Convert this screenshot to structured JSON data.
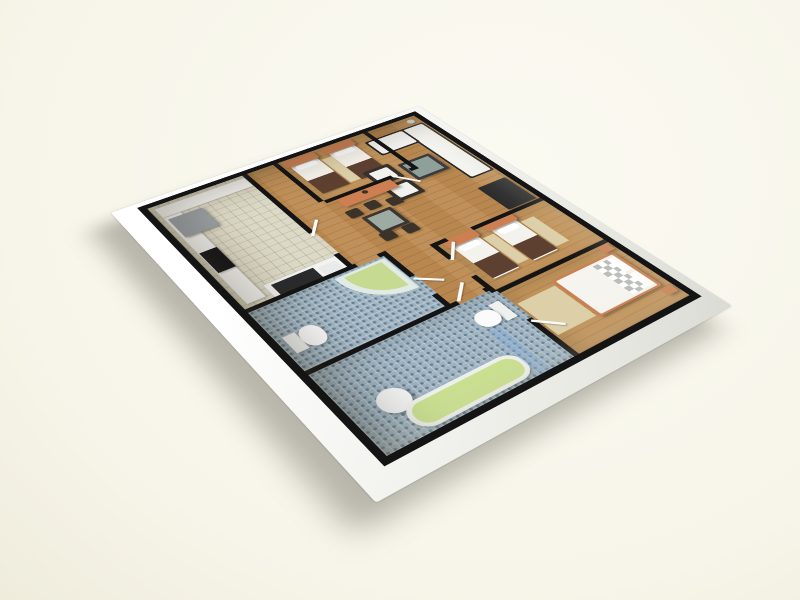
{
  "colors": {
    "--bg": "#f7f5e9",
    "--bg-light": "#fbfaf2",
    "--bg-dim": "#efecdc",
    "--wall": "#141414",
    "--wall-white": "#f4f4f1",
    "--wood": "#b8874f",
    "--wood-light": "#c2945c",
    "--tile": "#dcd9c6",
    "--mosaic": "#9fb2c0",
    "--accent-orange": "#cd7f52",
    "--linen-white": "#f4f2ec",
    "--throw-brown": "#5d4030",
    "--sofa-white": "#f4f4f1",
    "--dark-furniture": "#29292b",
    "--glass-green": "#aebfb7",
    "--tub-green": "#c9e08e",
    "--shower-green": "#c7da92",
    "--glass-blue": "rgba(130,170,215,0.4)",
    "--appliance-gray": "#9ba1a6"
  },
  "floor_plan": {
    "view": {
      "rotate_z_deg": -36,
      "rotate_x_deg": 57,
      "perspective_px": 1250
    },
    "rooms": [
      {
        "name": "floor-living-dining",
        "floor": "wood",
        "x": 0,
        "y": 0,
        "w": 400,
        "h": 500
      },
      {
        "name": "floor-kitchen",
        "floor": "tile",
        "x": 0,
        "y": 0,
        "w": 137,
        "h": 247
      },
      {
        "name": "floor-bathroom-1",
        "floor": "mosaic",
        "x": 0,
        "y": 247,
        "w": 182,
        "h": 120
      },
      {
        "name": "floor-bathroom-2",
        "floor": "mosaic",
        "x": 0,
        "y": 367,
        "w": 237,
        "h": 133
      },
      {
        "name": "floor-bedroom-1",
        "floor": "wood2",
        "x": 182,
        "y": 0,
        "w": 133,
        "h": 110
      },
      {
        "name": "floor-bedroom-2",
        "floor": "wood2",
        "x": 237,
        "y": 267,
        "w": 163,
        "h": 103
      },
      {
        "name": "floor-master-bedroom",
        "floor": "wood2",
        "x": 237,
        "y": 377,
        "w": 163,
        "h": 123
      }
    ],
    "walls": [
      {
        "name": "wall-kitchen-hall-a",
        "x": 130,
        "y": 0,
        "w": 7,
        "h": 160
      },
      {
        "name": "wall-kitchen-hall-b",
        "x": 130,
        "y": 212,
        "w": 7,
        "h": 35
      },
      {
        "name": "wall-hall-bedroom1",
        "x": 175,
        "y": 0,
        "w": 7,
        "h": 110
      },
      {
        "name": "wall-bedroom1-south-a",
        "x": 182,
        "y": 110,
        "w": 100,
        "h": 7
      },
      {
        "name": "wall-bedroom1-south-b",
        "x": 310,
        "y": 110,
        "w": 12,
        "h": 7
      },
      {
        "name": "wall-bedroom1-living",
        "x": 315,
        "y": 0,
        "w": 7,
        "h": 110
      },
      {
        "name": "wall-kitchen-south-a",
        "x": 0,
        "y": 240,
        "w": 140,
        "h": 7
      },
      {
        "name": "wall-kitchen-south-b",
        "x": 170,
        "y": 240,
        "w": 12,
        "h": 7
      },
      {
        "name": "wall-corridor-bath1-a",
        "x": 175,
        "y": 247,
        "w": 7,
        "h": 50
      },
      {
        "name": "wall-corridor-bath1-b",
        "x": 175,
        "y": 337,
        "w": 7,
        "h": 30
      },
      {
        "name": "wall-bath1-bath2-a",
        "x": 0,
        "y": 360,
        "w": 190,
        "h": 7
      },
      {
        "name": "wall-bath1-bath2-b",
        "x": 226,
        "y": 360,
        "w": 11,
        "h": 7
      },
      {
        "name": "wall-corridor-east-a",
        "x": 230,
        "y": 260,
        "w": 7,
        "h": 36
      },
      {
        "name": "wall-corridor-east-b",
        "x": 230,
        "y": 336,
        "w": 7,
        "h": 36
      },
      {
        "name": "wall-corridor-east-c",
        "x": 230,
        "y": 428,
        "w": 7,
        "h": 72
      },
      {
        "name": "wall-living-bedroom2-a",
        "x": 237,
        "y": 260,
        "w": 16,
        "h": 7
      },
      {
        "name": "wall-living-bedroom2-b",
        "x": 290,
        "y": 260,
        "w": 110,
        "h": 7
      },
      {
        "name": "wall-bedroom2-master",
        "x": 237,
        "y": 370,
        "w": 163,
        "h": 7
      }
    ],
    "doors": [
      {
        "name": "door-bedroom-1",
        "x": 284,
        "y": 112,
        "len": 36,
        "rot": 55
      },
      {
        "name": "door-bedroom-2",
        "x": 233,
        "y": 297,
        "len": 36,
        "rot": -50
      },
      {
        "name": "door-master",
        "x": 233,
        "y": 430,
        "len": 36,
        "rot": 45
      },
      {
        "name": "door-bath-2",
        "x": 192,
        "y": 360,
        "len": 34,
        "rot": -45
      },
      {
        "name": "door-bath-1",
        "x": 177,
        "y": 299,
        "len": 34,
        "rot": 40
      },
      {
        "name": "door-kitchen",
        "x": 131,
        "y": 164,
        "len": 34,
        "rot": -50
      }
    ],
    "furniture": [
      {
        "name": "rug-bedroom1",
        "x": 232,
        "y": 26,
        "w": 18,
        "h": 68,
        "fill": "#ddd0a8"
      },
      {
        "name": "rug-bedroom2-left",
        "x": 288,
        "y": 286,
        "w": 16,
        "h": 62,
        "fill": "#ddd0a8"
      },
      {
        "name": "rug-bedroom2-right",
        "x": 346,
        "y": 286,
        "w": 20,
        "h": 62,
        "fill": "#ddd0a8"
      },
      {
        "name": "rug-master",
        "x": 240,
        "y": 402,
        "w": 54,
        "h": 64,
        "fill": "#ddd0a8"
      },
      {
        "name": "kitchen-counter-north",
        "x": 6,
        "y": 6,
        "w": 124,
        "h": 24,
        "fill": "#f3f3f0",
        "cls": "counter"
      },
      {
        "name": "kitchen-counter-west",
        "x": 6,
        "y": 30,
        "w": 24,
        "h": 204,
        "fill": "#f3f3f0",
        "cls": "counter"
      },
      {
        "name": "fridge",
        "x": 10,
        "y": 36,
        "w": 44,
        "h": 46,
        "fill": "#9ba1a6",
        "cls": "raised"
      },
      {
        "name": "cooktop",
        "x": 8,
        "y": 120,
        "w": 22,
        "h": 46,
        "fill": "#17171a",
        "cls": "soft"
      },
      {
        "name": "kitchen-sink-counter",
        "x": 36,
        "y": 214,
        "w": 98,
        "h": 30,
        "fill": "#f3f3f0",
        "cls": "counter"
      },
      {
        "name": "kitchen-sink-top",
        "x": 44,
        "y": 219,
        "w": 54,
        "h": 21,
        "fill": "#2b2b2e"
      },
      {
        "name": "kitchen-sink-basin",
        "x": 102,
        "y": 222,
        "w": 24,
        "h": 17,
        "fill": "#e9ebeb",
        "r": 3
      },
      {
        "name": "bed1-a-mattress",
        "x": 190,
        "y": 8,
        "w": 40,
        "h": 88,
        "fill": "#f4f2ec",
        "r": 3,
        "cls": "soft"
      },
      {
        "name": "bed1-a-headboard",
        "x": 186,
        "y": 2,
        "w": 48,
        "h": 17,
        "fill": "#cd7f52",
        "r": 3,
        "cls": "raised"
      },
      {
        "name": "bed1-a-pillow",
        "x": 195,
        "y": 21,
        "w": 30,
        "h": 11,
        "fill": "#ffffff",
        "r": 3
      },
      {
        "name": "bed1-a-throw",
        "x": 190,
        "y": 60,
        "w": 40,
        "h": 36,
        "fill": "#5d4030"
      },
      {
        "name": "bed1-b-mattress",
        "x": 248,
        "y": 8,
        "w": 40,
        "h": 88,
        "fill": "#f4f2ec",
        "r": 3,
        "cls": "soft"
      },
      {
        "name": "bed1-b-headboard",
        "x": 244,
        "y": 2,
        "w": 48,
        "h": 17,
        "fill": "#cd7f52",
        "r": 3,
        "cls": "raised"
      },
      {
        "name": "bed1-b-pillow",
        "x": 253,
        "y": 21,
        "w": 30,
        "h": 11,
        "fill": "#ffffff",
        "r": 3
      },
      {
        "name": "bed1-b-throw",
        "x": 248,
        "y": 60,
        "w": 40,
        "h": 36,
        "fill": "#5d4030"
      },
      {
        "name": "sofa-base",
        "x": 360,
        "y": 22,
        "w": 38,
        "h": 154,
        "fill": "#242424",
        "r": 3
      },
      {
        "name": "sofa-seat",
        "x": 363,
        "y": 25,
        "w": 32,
        "h": 148,
        "fill": "#f4f4f1",
        "r": 3
      },
      {
        "name": "sofa-return-base",
        "x": 302,
        "y": 22,
        "w": 62,
        "h": 42,
        "fill": "#242424",
        "r": 3
      },
      {
        "name": "sofa-return-seat",
        "x": 305,
        "y": 25,
        "w": 56,
        "h": 36,
        "fill": "#f4f4f1",
        "r": 3
      },
      {
        "name": "coffee-table",
        "x": 304,
        "y": 94,
        "w": 50,
        "h": 46,
        "fill": "#3a3a3c",
        "r": 2,
        "cls": "raised"
      },
      {
        "name": "coffee-table-glass",
        "x": 309,
        "y": 99,
        "w": 40,
        "h": 36,
        "fill": "#9fb3ac",
        "op": 0.85
      },
      {
        "name": "tv-bench",
        "x": 352,
        "y": 198,
        "w": 44,
        "h": 60,
        "fill": "#29292b",
        "r": 2,
        "cls": "raised"
      },
      {
        "name": "armchair-1",
        "x": 256,
        "y": 84,
        "w": 40,
        "h": 38,
        "fill": "#36302a",
        "r": 3,
        "cls": "soft"
      },
      {
        "name": "armchair-1-cushion",
        "x": 262,
        "y": 90,
        "w": 28,
        "h": 26,
        "fill": "#f1f1ee",
        "r": 2
      },
      {
        "name": "armchair-2",
        "x": 256,
        "y": 128,
        "w": 40,
        "h": 38,
        "fill": "#36302a",
        "r": 3,
        "cls": "soft"
      },
      {
        "name": "armchair-2-cushion",
        "x": 262,
        "y": 134,
        "w": 28,
        "h": 26,
        "fill": "#f1f1ee",
        "r": 2
      },
      {
        "name": "sideboard",
        "x": 196,
        "y": 116,
        "w": 80,
        "h": 22,
        "fill": "#cd7f52",
        "cls": "raised"
      },
      {
        "name": "sideboard-vase",
        "x": 230,
        "y": 119,
        "w": 8,
        "h": 8,
        "fill": "#3c3326",
        "r": 4
      },
      {
        "name": "floor-lamp",
        "x": 381,
        "y": 6,
        "w": 11,
        "h": 11,
        "fill": "#d9d9d3",
        "r": 6,
        "cls": "soft"
      },
      {
        "name": "dining-table",
        "x": 198,
        "y": 168,
        "w": 42,
        "h": 42,
        "fill": "#3c362e",
        "r": 2,
        "cls": "raised"
      },
      {
        "name": "dining-table-glass",
        "x": 203,
        "y": 173,
        "w": 32,
        "h": 32,
        "fill": "#aebfb7",
        "op": 0.85
      },
      {
        "name": "dining-chair-1",
        "x": 188,
        "y": 146,
        "w": 18,
        "h": 18,
        "fill": "#3b332a",
        "r": 3,
        "cls": "soft"
      },
      {
        "name": "dining-chair-2",
        "x": 216,
        "y": 144,
        "w": 18,
        "h": 18,
        "fill": "#3b332a",
        "r": 3,
        "cls": "soft"
      },
      {
        "name": "dining-chair-3",
        "x": 243,
        "y": 152,
        "w": 18,
        "h": 18,
        "fill": "#3b332a",
        "r": 3,
        "cls": "soft"
      },
      {
        "name": "dining-chair-4",
        "x": 194,
        "y": 208,
        "w": 18,
        "h": 18,
        "fill": "#3b332a",
        "r": 3,
        "cls": "soft"
      },
      {
        "name": "dining-chair-5",
        "x": 224,
        "y": 211,
        "w": 18,
        "h": 18,
        "fill": "#3b332a",
        "r": 3,
        "cls": "soft"
      },
      {
        "name": "bed2-a-mattress",
        "x": 248,
        "y": 270,
        "w": 38,
        "h": 84,
        "fill": "#f4f2ec",
        "r": 3,
        "cls": "soft"
      },
      {
        "name": "bed2-a-headboard",
        "x": 244,
        "y": 264,
        "w": 46,
        "h": 16,
        "fill": "#cd7f52",
        "r": 3,
        "cls": "raised"
      },
      {
        "name": "bed2-a-pillow",
        "x": 253,
        "y": 283,
        "w": 28,
        "h": 11,
        "fill": "#ffffff",
        "r": 3
      },
      {
        "name": "bed2-a-throw",
        "x": 248,
        "y": 318,
        "w": 38,
        "h": 34,
        "fill": "#5d4030"
      },
      {
        "name": "bed2-b-mattress",
        "x": 306,
        "y": 270,
        "w": 38,
        "h": 84,
        "fill": "#f4f2ec",
        "r": 3,
        "cls": "soft"
      },
      {
        "name": "bed2-b-headboard",
        "x": 302,
        "y": 264,
        "w": 46,
        "h": 16,
        "fill": "#cd7f52",
        "r": 3,
        "cls": "raised"
      },
      {
        "name": "bed2-b-pillow",
        "x": 311,
        "y": 283,
        "w": 28,
        "h": 11,
        "fill": "#ffffff",
        "r": 3
      },
      {
        "name": "bed2-b-throw",
        "x": 306,
        "y": 318,
        "w": 38,
        "h": 34,
        "fill": "#5d4030"
      },
      {
        "name": "master-bed-frame",
        "x": 296,
        "y": 394,
        "w": 94,
        "h": 76,
        "fill": "#cd7f52",
        "r": 3,
        "cls": "raised"
      },
      {
        "name": "master-bed-mattress",
        "x": 300,
        "y": 397,
        "w": 86,
        "h": 70,
        "fill": "#f5f4ef",
        "r": 2
      },
      {
        "name": "master-bed-checker",
        "x": 352,
        "y": 401,
        "w": 22,
        "h": 62,
        "cls": "checker"
      },
      {
        "name": "master-pillow-1",
        "x": 374,
        "y": 401,
        "w": 12,
        "h": 28,
        "fill": "#ffffff",
        "r": 2
      },
      {
        "name": "master-pillow-2",
        "x": 374,
        "y": 435,
        "w": 12,
        "h": 28,
        "fill": "#ffffff",
        "r": 2
      },
      {
        "name": "master-nightstand-1",
        "x": 382,
        "y": 378,
        "w": 15,
        "h": 13,
        "fill": "#cd7f52",
        "cls": "raised"
      },
      {
        "name": "master-nightstand-2",
        "x": 382,
        "y": 474,
        "w": 15,
        "h": 13,
        "fill": "#cd7f52",
        "cls": "raised"
      },
      {
        "name": "shower-tray",
        "x": 106,
        "y": 251,
        "w": 68,
        "h": 66,
        "fill": "#e3eae6",
        "r": "0 0 0 64px",
        "cls": "soft"
      },
      {
        "name": "shower-basin",
        "x": 116,
        "y": 255,
        "w": 50,
        "h": 52,
        "fill": "#c7da92",
        "r": "0 0 0 50px"
      },
      {
        "name": "shower-glass",
        "x": 102,
        "y": 249,
        "w": 72,
        "h": 70,
        "cls": "glassarc",
        "r": "0 0 0 68px",
        "op": 0.8
      },
      {
        "name": "toilet1-tank",
        "x": 8,
        "y": 303,
        "w": 15,
        "h": 30,
        "fill": "#eff1f1",
        "cls": "soft"
      },
      {
        "name": "toilet1-bowl",
        "x": 23,
        "y": 301,
        "w": 26,
        "h": 34,
        "fill": "#fbfbfb",
        "r": "45%",
        "cls": "soft"
      },
      {
        "name": "toilet2-tank",
        "x": 213,
        "y": 386,
        "w": 14,
        "h": 32,
        "fill": "#eff1f1",
        "cls": "soft"
      },
      {
        "name": "toilet2-bowl",
        "x": 185,
        "y": 389,
        "w": 28,
        "h": 27,
        "fill": "#fbfbfb",
        "r": "45%",
        "cls": "soft"
      },
      {
        "name": "washbasin",
        "x": 30,
        "y": 428,
        "w": 35,
        "h": 35,
        "fill": "#f2f4f4",
        "r": "50%",
        "cls": "raised"
      },
      {
        "name": "bathtub-rim",
        "x": 44,
        "y": 456,
        "w": 142,
        "h": 40,
        "fill": "#eef1ec",
        "r": 20,
        "cls": "soft"
      },
      {
        "name": "bathtub-basin",
        "x": 50,
        "y": 461,
        "w": 130,
        "h": 30,
        "fill": "#c9e08e",
        "r": 14
      },
      {
        "name": "bath2-glass-screen",
        "x": 184,
        "y": 420,
        "w": 16,
        "h": 80,
        "fill": "rgba(130,170,215,0.40)"
      }
    ]
  }
}
